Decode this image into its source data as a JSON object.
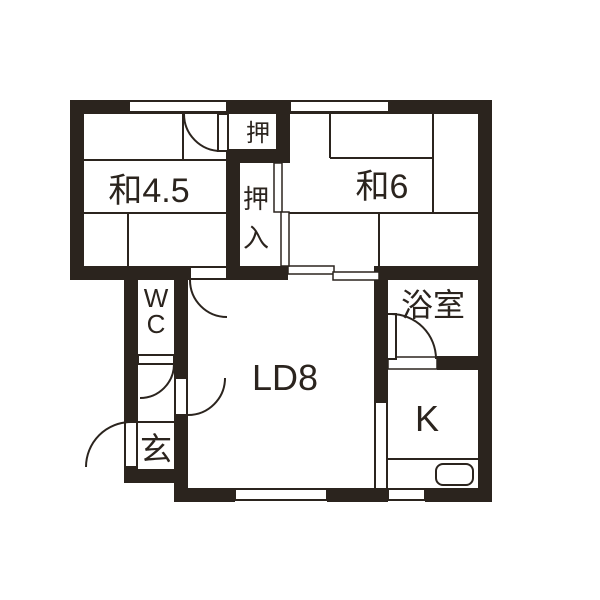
{
  "plan": {
    "type": "apartment-floor-plan",
    "rooms": {
      "japanese_room_45": {
        "label": "和4.5"
      },
      "japanese_room_6": {
        "label": "和6"
      },
      "closet_small": {
        "label": "押"
      },
      "closet_large": {
        "label_line1": "押",
        "label_line2": "入",
        "full": "押入"
      },
      "toilet": {
        "label_line1": "W",
        "label_line2": "C",
        "full": "WC"
      },
      "living_dining": {
        "label": "LD8"
      },
      "bathroom": {
        "label": "浴室"
      },
      "kitchen": {
        "label": "K"
      },
      "entrance": {
        "label": "玄"
      }
    },
    "colors": {
      "wall": "#2b241e",
      "line": "#2b241e",
      "background": "#ffffff"
    }
  }
}
